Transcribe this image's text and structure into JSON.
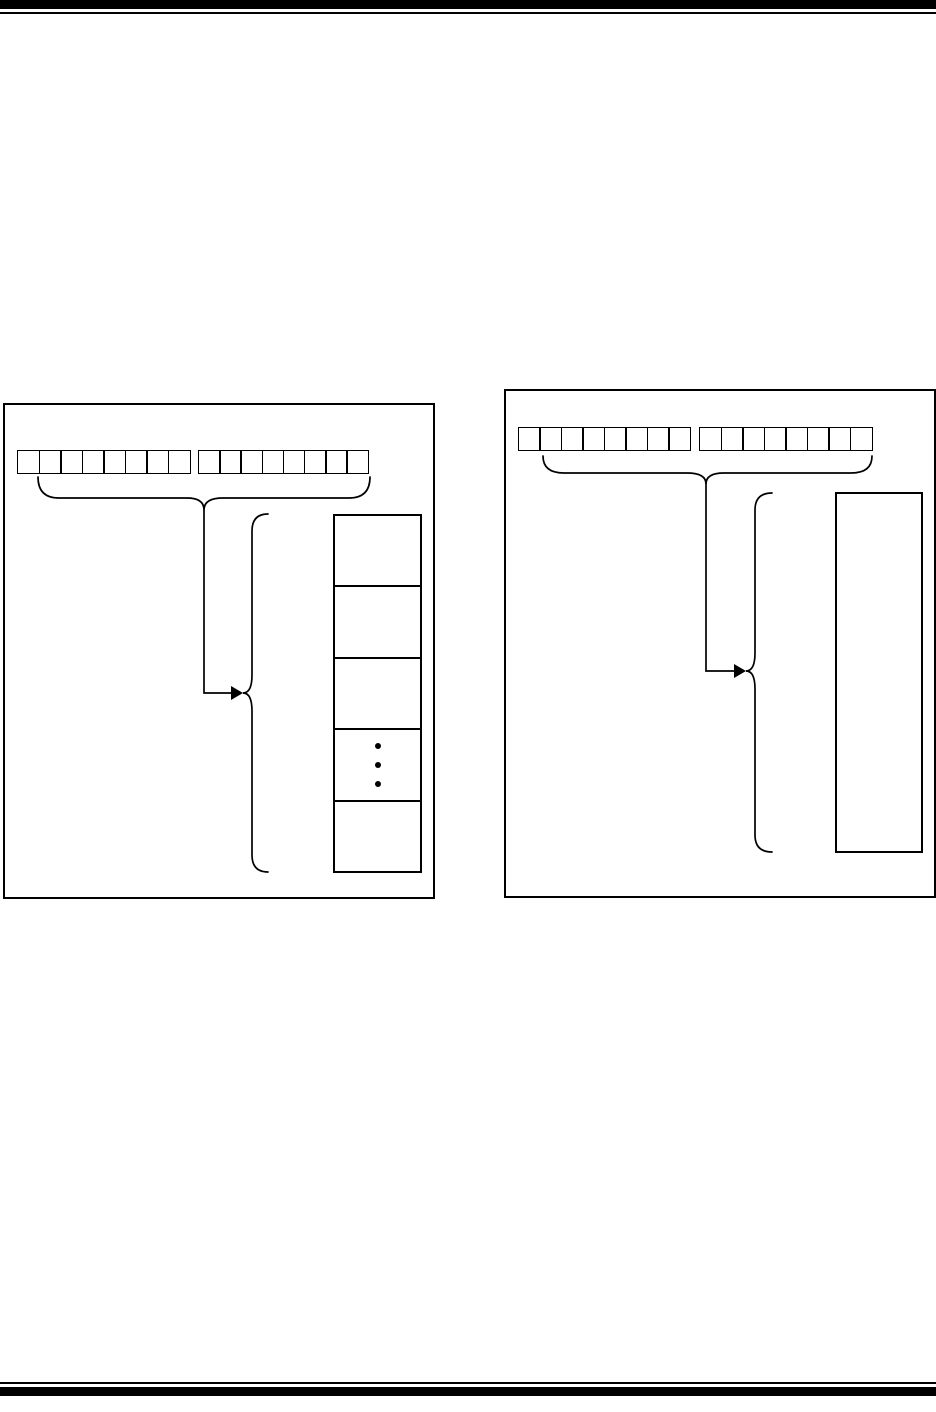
{
  "page": {
    "paper_color": "#ffffff",
    "ink_color": "#000000",
    "header_rules": [
      "thick-bar",
      "thin-line"
    ],
    "footer_rules": [
      "thin-line",
      "thick-bar"
    ],
    "visible_text": []
  },
  "figures": {
    "left": {
      "kind": "register-pair-pointing-to-memory-rows",
      "register_groups": [
        {
          "bits": 8
        },
        {
          "bits": 8
        }
      ],
      "graphics": [
        "registers-span-brace",
        "pointer-line",
        "arrow-head-icon",
        "memory-span-brace"
      ],
      "memory": {
        "rows": 5,
        "ellipsis_row_index": 3,
        "ellipsis_dots": 3
      }
    },
    "right": {
      "kind": "register-pair-pointing-to-memory-block",
      "register_groups": [
        {
          "bits": 8
        },
        {
          "bits": 8
        }
      ],
      "graphics": [
        "registers-span-brace",
        "pointer-line",
        "arrow-head-icon",
        "memory-span-brace"
      ],
      "memory": {
        "rows": 1,
        "ellipsis_row_index": -1,
        "ellipsis_dots": 0
      }
    }
  }
}
